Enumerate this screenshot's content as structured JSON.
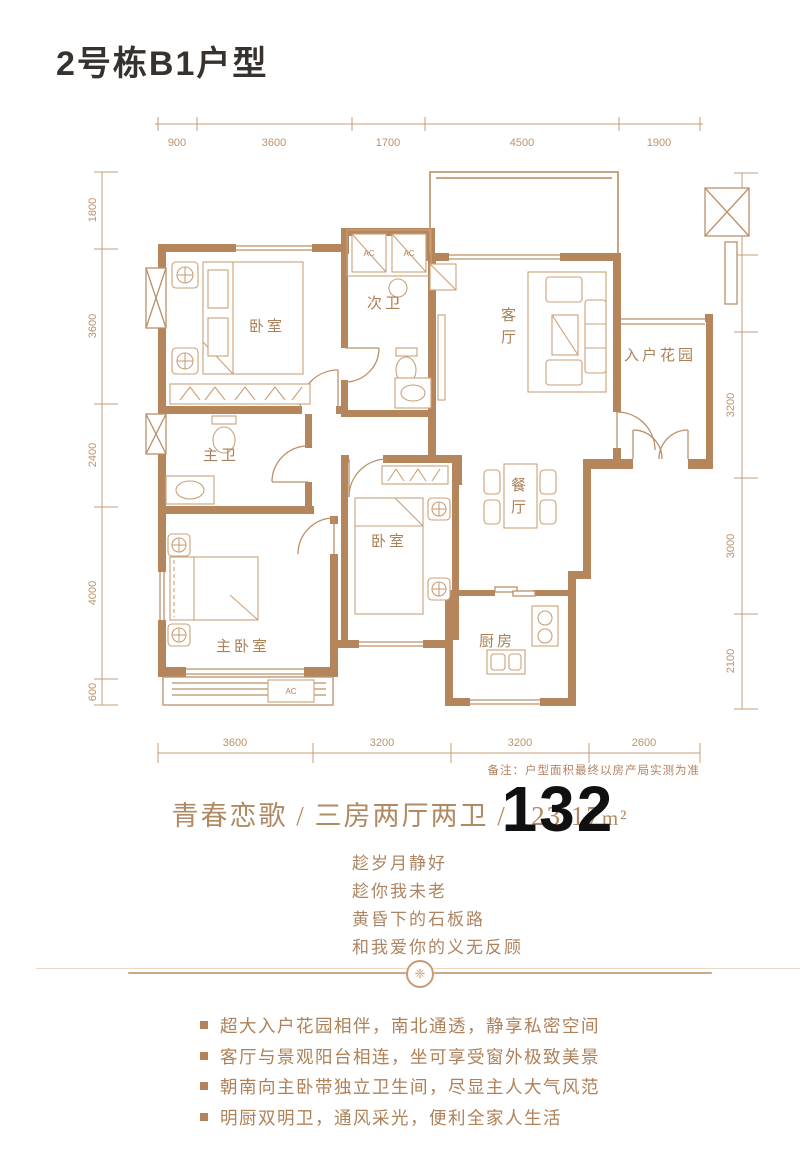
{
  "page": {
    "title": "2号栋B1户型"
  },
  "plan": {
    "note": "备注：户型面积最终以房产局实测为准",
    "dims": {
      "top": [
        "900",
        "3600",
        "1700",
        "4500",
        "1900"
      ],
      "left": [
        "1800",
        "3600",
        "2400",
        "4000",
        "600"
      ],
      "right": [
        "1800",
        "1700",
        "3200",
        "3000",
        "2100"
      ],
      "bottom": [
        "3600",
        "3200",
        "3200",
        "2600"
      ]
    },
    "rooms": {
      "bedroom1": "卧室",
      "second_bath": "次卫",
      "living": {
        "chars": [
          "客",
          "厅"
        ]
      },
      "entry_garden": "入户花园",
      "master_bath": "主卫",
      "dining": {
        "chars": [
          "餐",
          "厅"
        ]
      },
      "bedroom2": "卧室",
      "master_bedroom": "主卧室",
      "kitchen": "厨房",
      "ac_label": "AC"
    }
  },
  "headline": {
    "prefix": "青春恋歌 / 三房两厅两卫 / ",
    "area": "123.17",
    "unit": "m²",
    "overlay_number": "132"
  },
  "poem": {
    "lines": [
      "趁岁月静好",
      "趁你我未老",
      "黄昏下的石板路",
      "和我爱你的义无反顾"
    ]
  },
  "divider": {
    "ornament": "❈"
  },
  "features": {
    "items": [
      "超大入户花园相伴，南北通透，静享私密空间",
      "客厅与景观阳台相连，坐可享受窗外极致美景",
      "朝南向主卧带独立卫生间，尽显主人大气风范",
      "明厨双明卫，通风采光，便利全家人生活"
    ]
  },
  "colors": {
    "wall": "#b5855c",
    "accent": "#b08a63",
    "overlay_number": "#101010"
  }
}
